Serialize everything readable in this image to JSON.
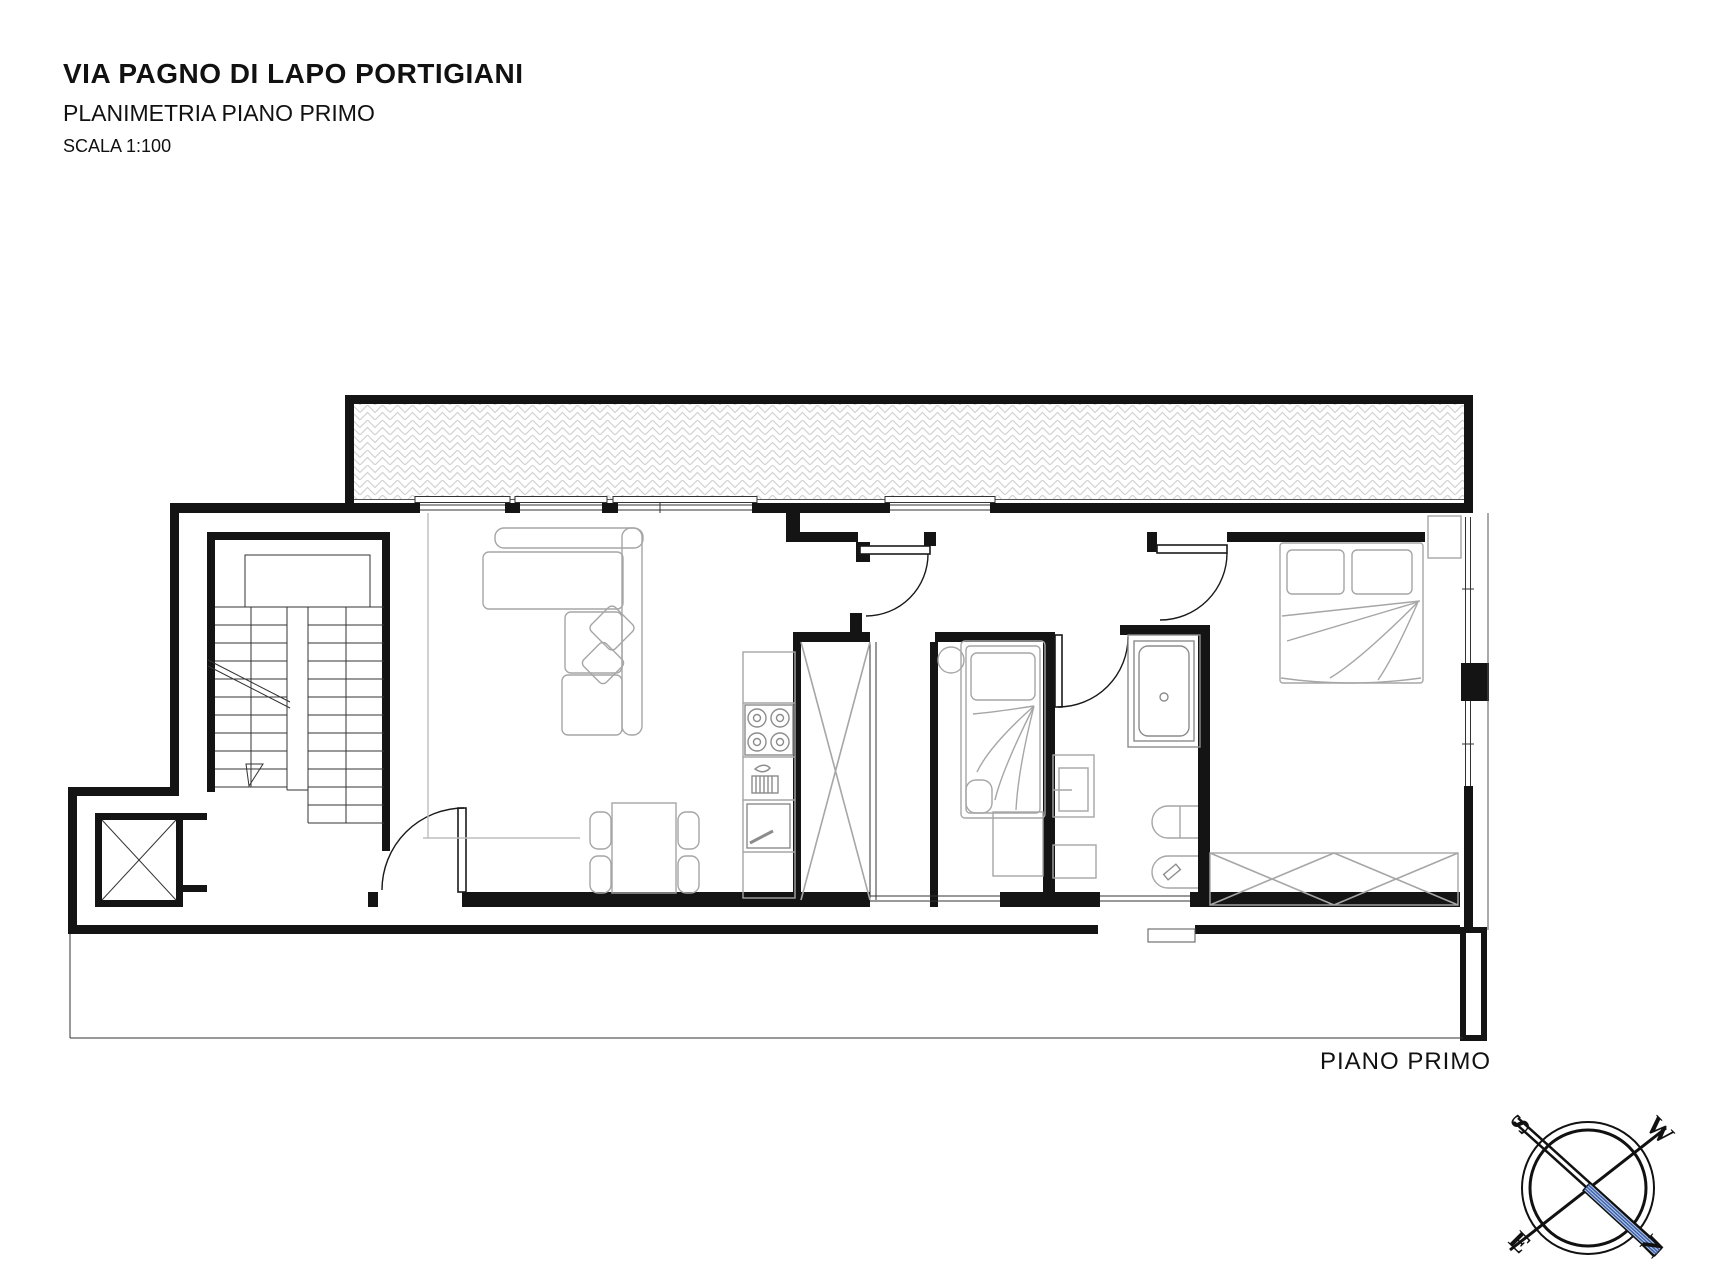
{
  "header": {
    "title": "VIA PAGNO DI LAPO PORTIGIANI",
    "subtitle": "PLANIMETRIA PIANO PRIMO",
    "scale": "SCALA 1:100"
  },
  "plan": {
    "floor_label": "PIANO PRIMO",
    "type": "apartment floor plan",
    "rooms": [
      "terrazza",
      "soggiorno-cucina",
      "disimpegno",
      "camera singola",
      "bagno",
      "camera matrimoniale",
      "vano scala",
      "ascensore"
    ]
  },
  "compass": {
    "north": "N",
    "south": "S",
    "east": "E",
    "west": "W"
  },
  "colors": {
    "wall": "#141414",
    "furniture": "#a6a6a6",
    "hatch": "#d2d2d2",
    "needle_fill": "#b3c6e8",
    "needle_stripe": "#3b5ea8"
  }
}
